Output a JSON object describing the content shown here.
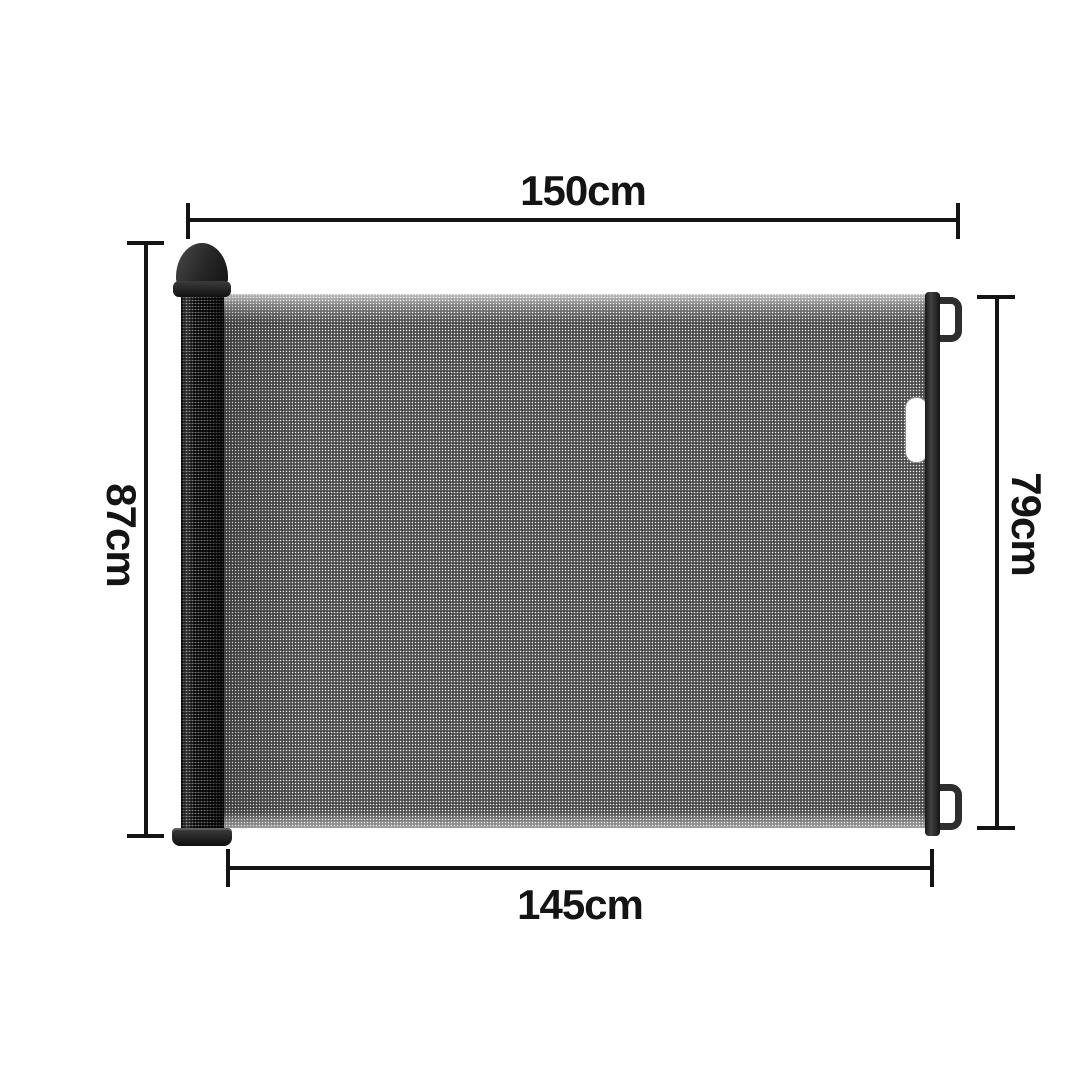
{
  "labels": {
    "top_width": "150cm",
    "bottom_width": "145cm",
    "left_height": "87cm",
    "right_height": "79cm"
  },
  "colors": {
    "background": "#ffffff",
    "annotation": "#141414",
    "frame_dark": "#2e2e2e",
    "mesh_gray": "#8f8f8f"
  }
}
